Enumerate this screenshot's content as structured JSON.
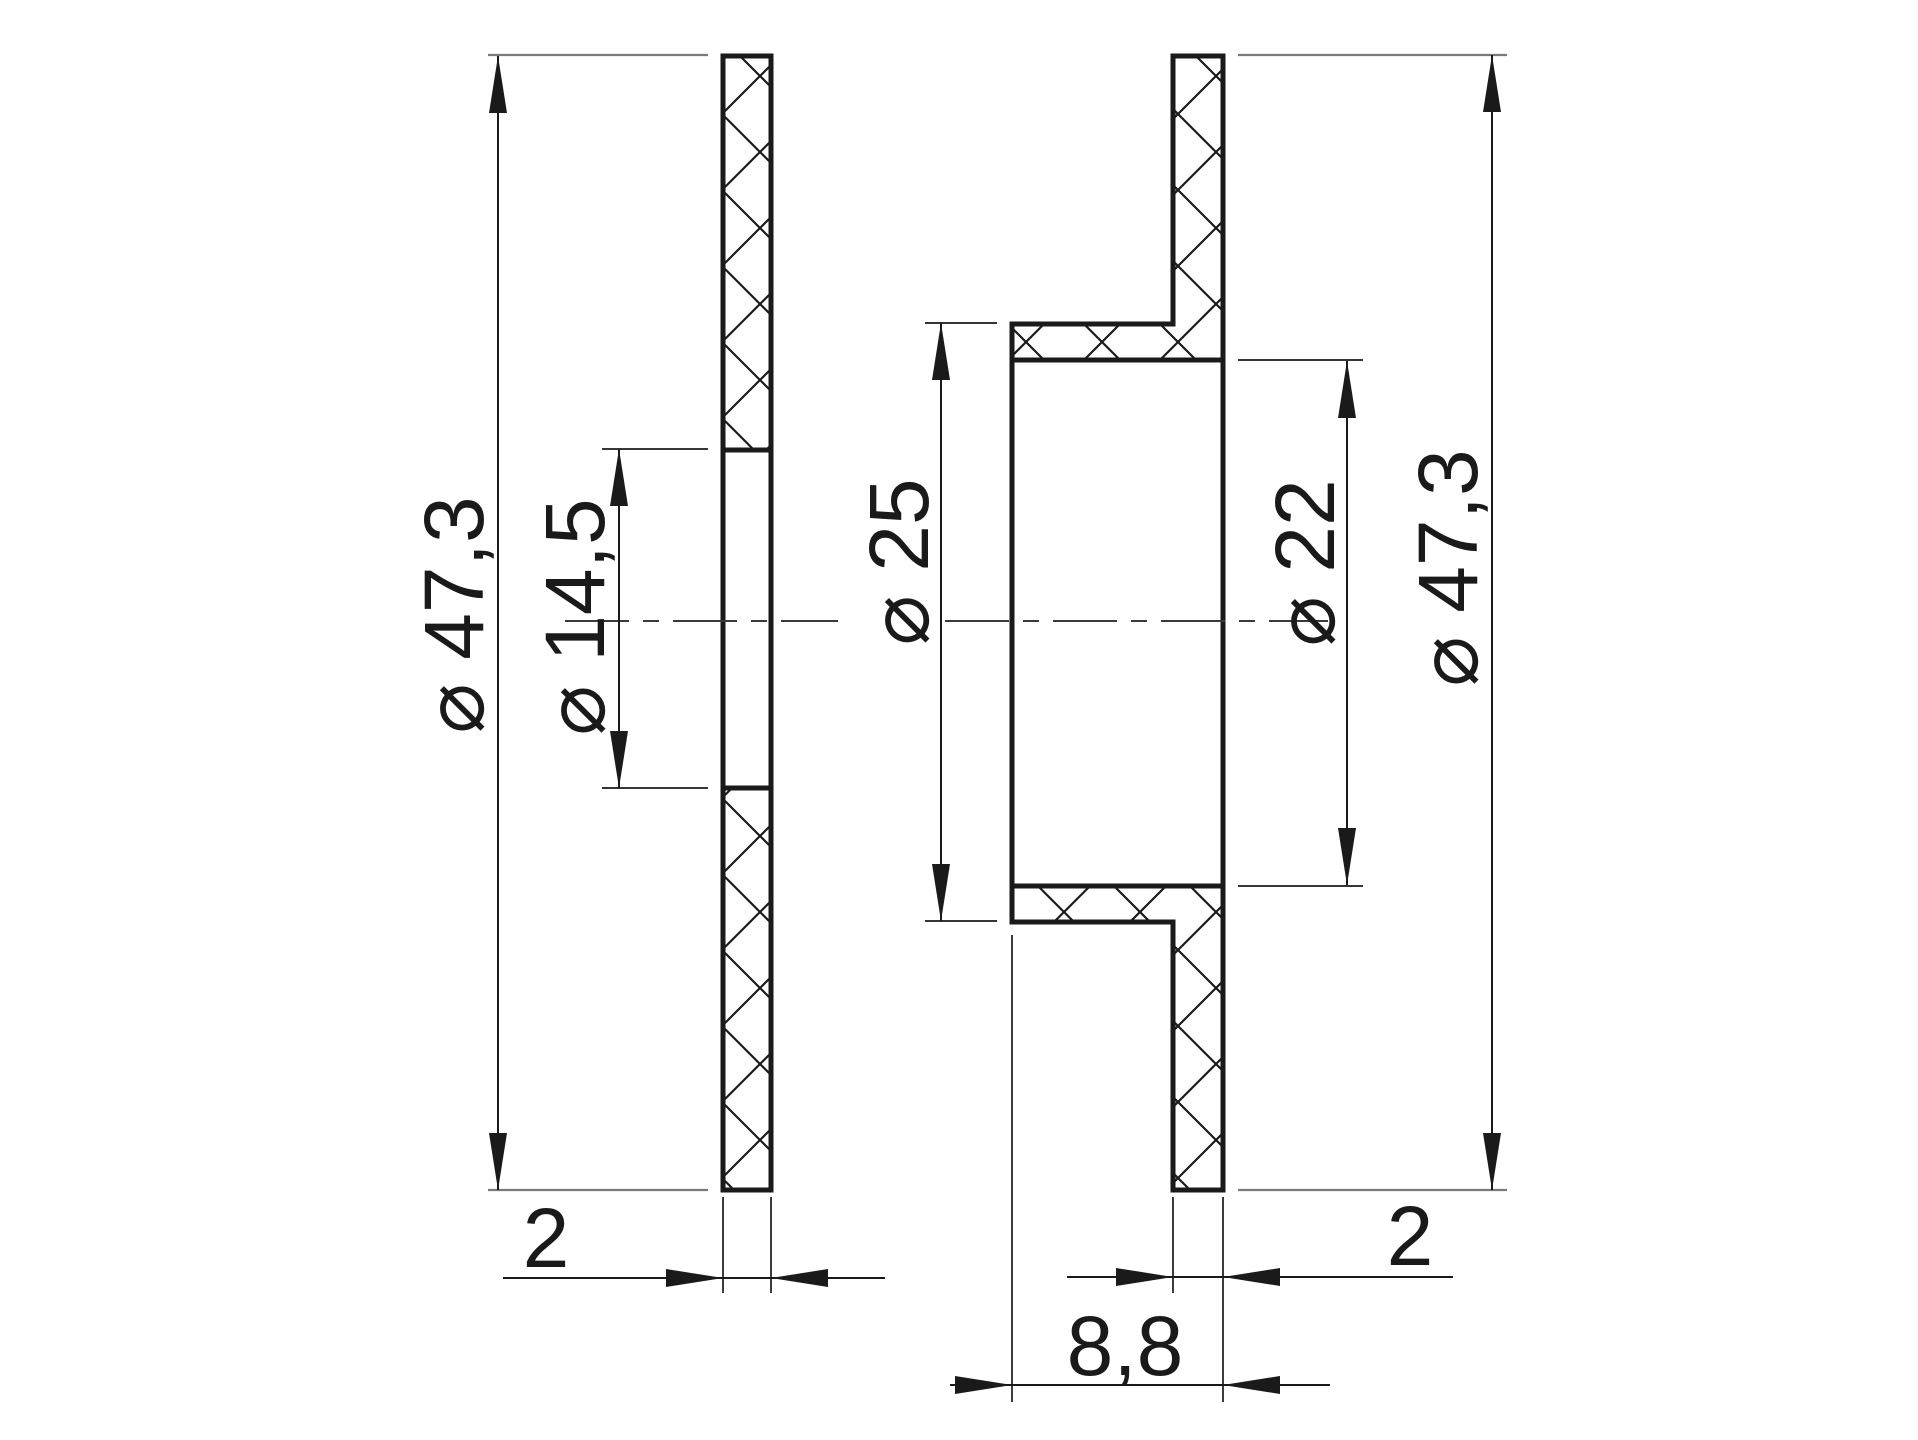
{
  "colors": {
    "background": "#ffffff",
    "line": "#1a1a1a",
    "extension-line": "#7a7a7a",
    "hatch": "#1a1a1a"
  },
  "drawing": {
    "left_view": {
      "outer_diameter": "⌀ 47,3",
      "bore_diameter": "⌀ 14,5",
      "thickness": "2"
    },
    "right_view": {
      "body_diameter": "⌀ 25",
      "bore_diameter": "⌀ 22",
      "flange_diameter": "⌀ 47,3",
      "flange_thickness": "2",
      "body_length": "8,8"
    }
  }
}
